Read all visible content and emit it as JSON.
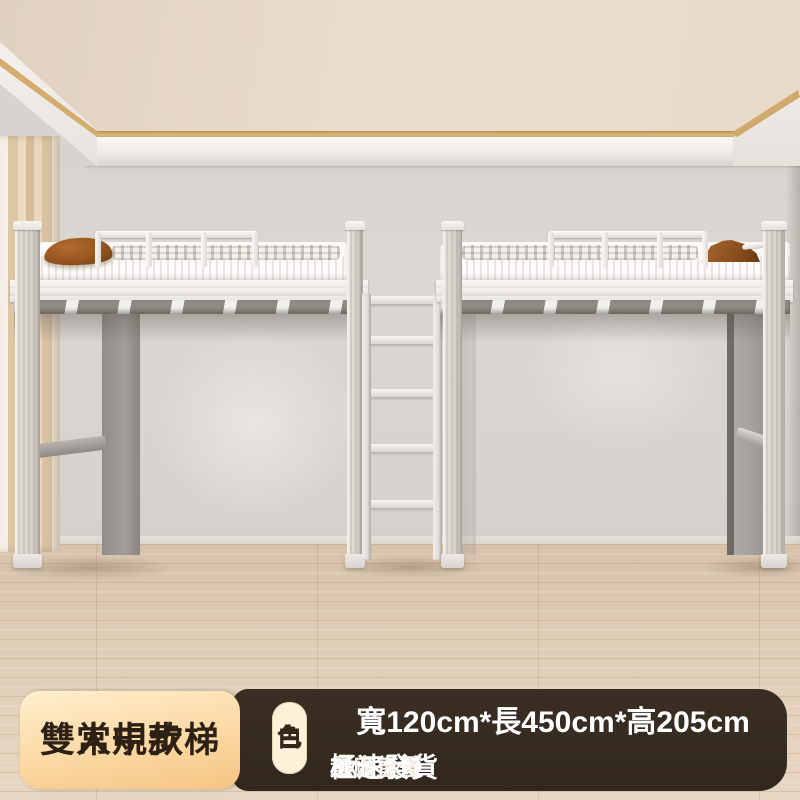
{
  "banner": {
    "product_name_line1": "雙人中步梯",
    "product_name_line2": "常規款",
    "variant": "白色",
    "variant_chars": [
      "白",
      "色"
    ],
    "dimensions": "寬120cm*長450cm*高205cm",
    "perks": [
      "工廠直營",
      "量大從優",
      "極速發貨"
    ],
    "colors": {
      "bar_background": "#382c21",
      "name_card_top": "#ffeecd",
      "name_card_bottom": "#f5c483",
      "name_text": "#2d2014",
      "variant_pill_background": "#fcf2da",
      "variant_text": "#33281a",
      "dimensions_text": "#ffffff",
      "perks_text": "#f6f1e9"
    }
  },
  "scene": {
    "description": "Two white metal loft beds with middle ladder in a bright room",
    "colors": {
      "wall": "#d9d4d0",
      "ceiling": "#e9dbcc",
      "led_strip": "#dcb87e",
      "curtain": "#dcc6a6",
      "floor_wood": "#e0cdb7",
      "bed_frame": "#f2f0ed",
      "pillow": "#96551f"
    }
  }
}
